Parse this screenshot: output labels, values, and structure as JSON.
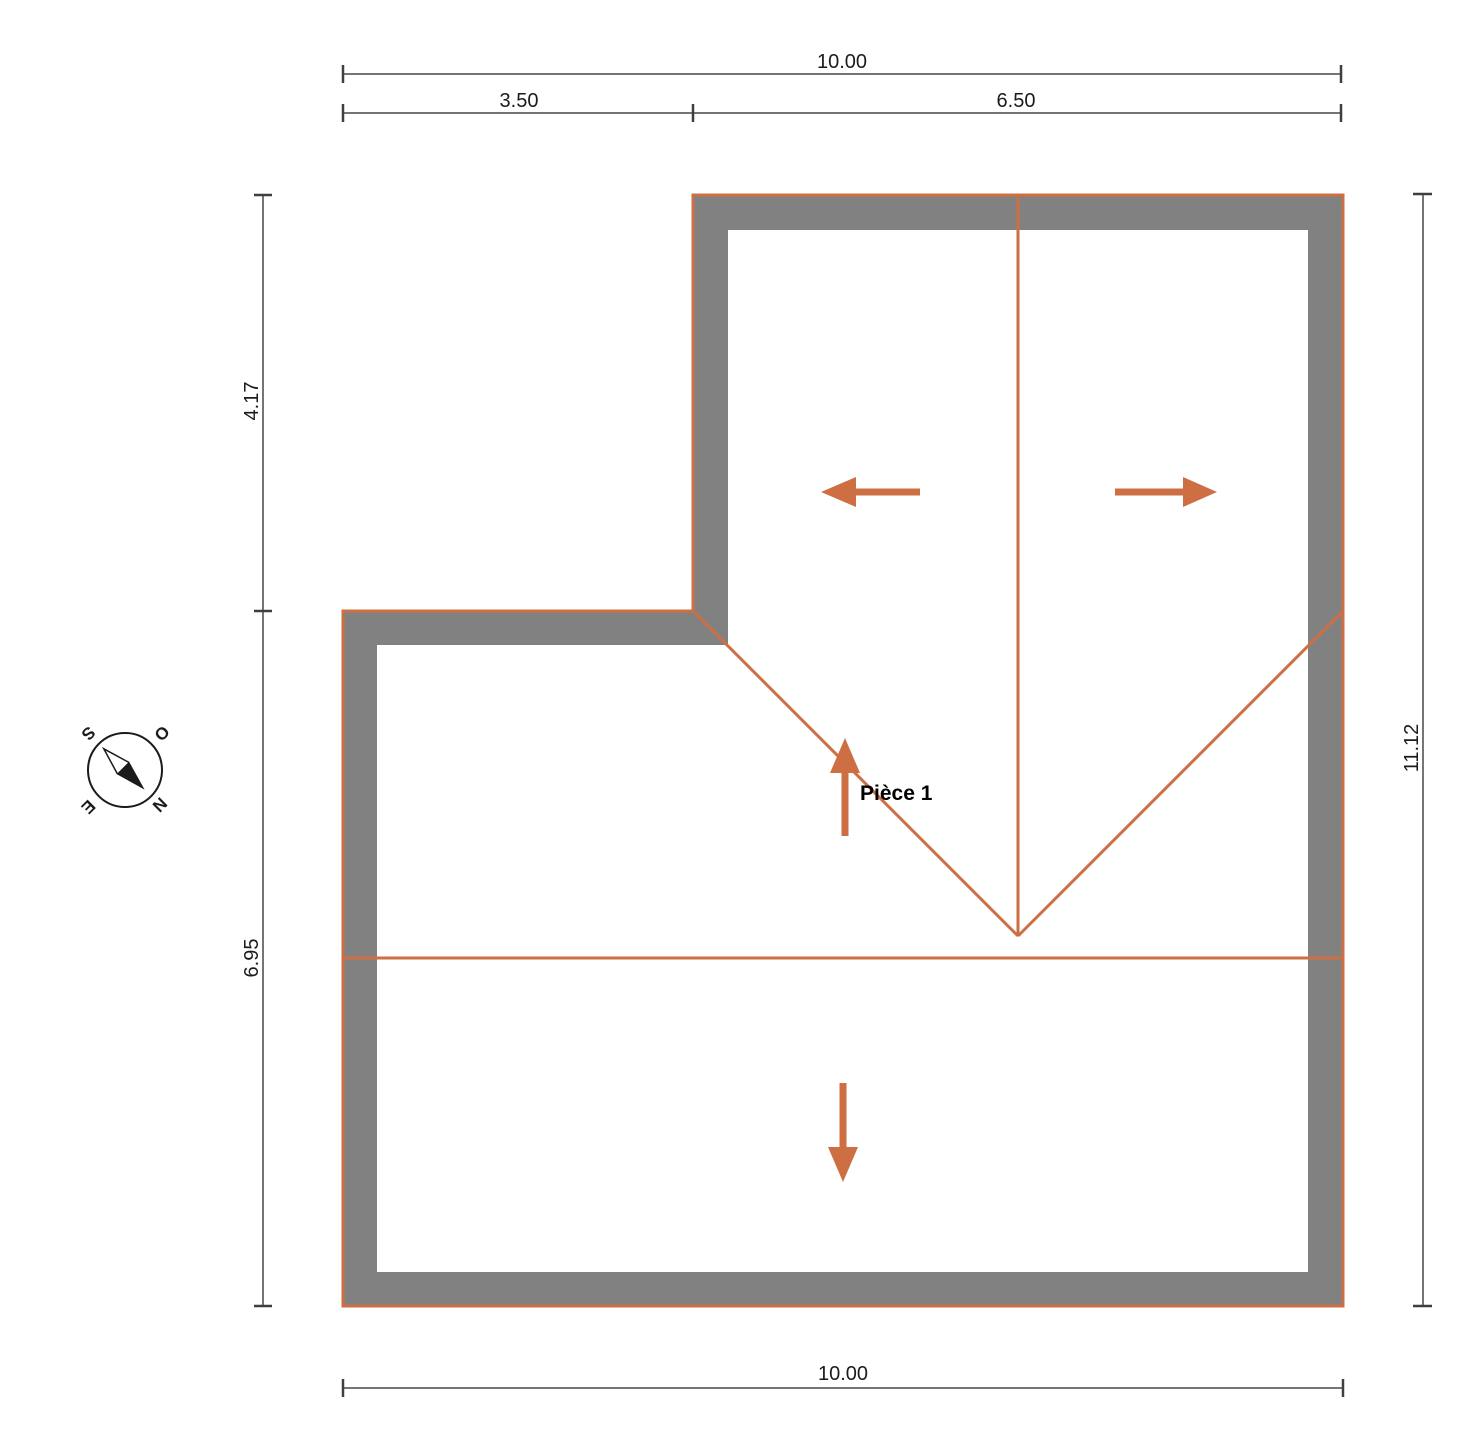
{
  "plan": {
    "room_label": "Pièce 1"
  },
  "dimensions": {
    "top": {
      "total": "10.00",
      "left_segment": "3.50",
      "right_segment": "6.50"
    },
    "left": {
      "upper": "4.17",
      "lower": "6.95"
    },
    "right": {
      "total": "11.12"
    },
    "bottom": {
      "total": "10.00"
    }
  },
  "compass": {
    "north": "N",
    "south": "S",
    "east": "E",
    "west": "O"
  },
  "colors": {
    "roof_line": "#CD6F42",
    "wall_fill": "#818181",
    "dimension_line": "#757575",
    "tick": "#3F3F3F",
    "label_text": "#1B1B1B"
  }
}
